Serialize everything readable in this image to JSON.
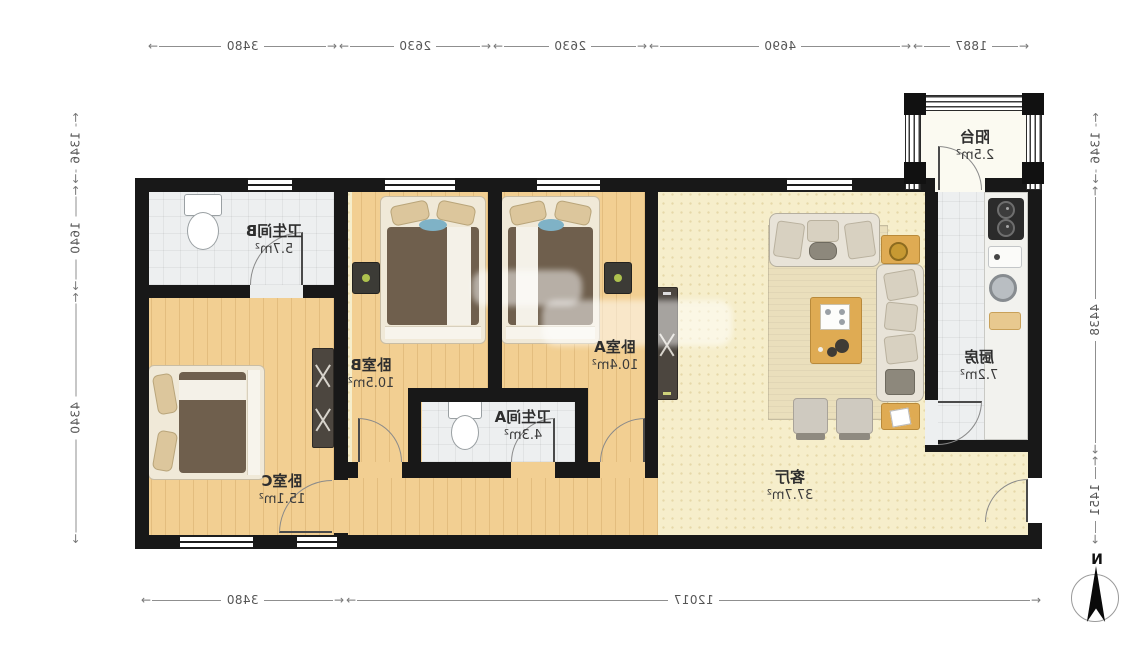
{
  "rooms": {
    "bathroom_b": {
      "name": "卫生间B",
      "area": "5.7m²"
    },
    "bedroom_c": {
      "name": "卧室C",
      "area": "15.1m²"
    },
    "bedroom_b": {
      "name": "卧室B",
      "area": "10.5m²"
    },
    "bedroom_a": {
      "name": "卧室A",
      "area": "10.4m²"
    },
    "bathroom_a": {
      "name": "卫生间A",
      "area": "4.3m²"
    },
    "living": {
      "name": "客厅",
      "area": "37.7m²"
    },
    "kitchen": {
      "name": "厨房",
      "area": "7.2m²"
    },
    "balcony": {
      "name": "阳台",
      "area": "2.5m²"
    }
  },
  "dims": {
    "top": [
      {
        "value": "3480"
      },
      {
        "value": "2630"
      },
      {
        "value": "2630"
      },
      {
        "value": "4690"
      },
      {
        "value": "1887"
      }
    ],
    "bottom": [
      {
        "value": "3480"
      },
      {
        "value": "12017"
      }
    ],
    "left_edge": [
      {
        "value": "1346"
      },
      {
        "value": "1640"
      },
      {
        "value": "4340"
      }
    ],
    "right_edge": [
      {
        "value": "1346"
      },
      {
        "value": "4438"
      },
      {
        "value": "1451"
      }
    ]
  },
  "compass": {
    "label": "N"
  },
  "colors": {
    "wall": "#181818",
    "wood_floor": "#f2cf92",
    "living_floor": "#f6eecb",
    "tile_floor": "#edeff0"
  }
}
